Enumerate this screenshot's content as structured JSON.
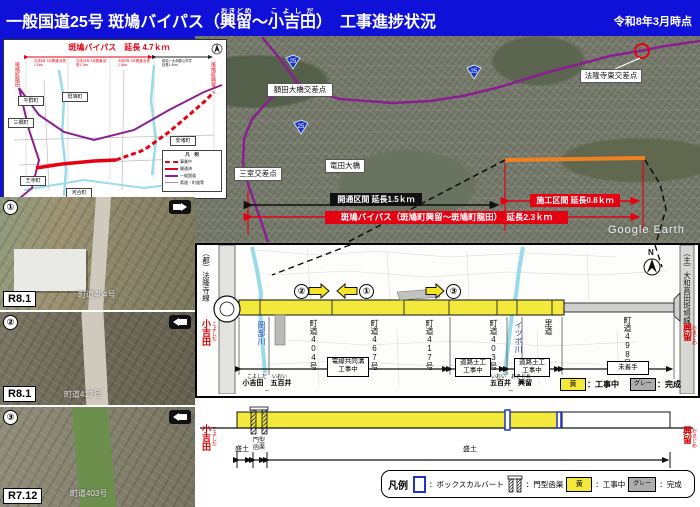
{
  "colors": {
    "header_bg": "#0f10d8",
    "red": "#e60012",
    "yellow": "#f2e93c",
    "orange": "#f08020",
    "purple": "#8a2090",
    "cyan": "#9adbe8",
    "gray_done": "#adadad"
  },
  "header": {
    "title_pre": "一般国道25号 斑鳩バイパス（",
    "r1": "興留",
    "r1_kana": "おきどめ",
    "tilde": "～",
    "r2": "小吉田",
    "r2_kana": "こよしだ",
    "title_post": "）　工事進捗状況",
    "date": "令和8年3月時点"
  },
  "inset": {
    "title": "斑鳩バイパス　延長 4.7ｋｍ",
    "left_end": "斑鳩町龍田",
    "right_end": "斑鳩町興留",
    "towns": [
      "平群町",
      "斑鳩町",
      "三郷町",
      "安堵町",
      "王寺町",
      "河合町"
    ],
    "history": [
      "平成8年 3月開通 延長1.1km",
      "平成23年 3月開通 延長1.7km",
      "令和3年 3月開通 延長1.3km",
      "斑鳩～大和郡山市境 延長1.4km"
    ],
    "legend_title": "凡　例",
    "legend": [
      "事業中",
      "開通済",
      "一般国道",
      "県道・町道等"
    ]
  },
  "aerial": {
    "int_west": "額田大橋交差点",
    "int_east": "法隆寺東交差点",
    "int_mimuro": "三室交差点",
    "bridge": "竜田大橋",
    "shield": "25",
    "opened": "開通区間 延長1.5ｋｍ",
    "constructing": "施工区間 延長0.8ｋｍ",
    "total": "斑鳩バイパス（斑鳩町興留～斑鳩町龍田）　延長2.3ｋｍ",
    "watermark": "Google Earth"
  },
  "photos": [
    {
      "no": "①",
      "date": "R8.1",
      "caption": "町道404号"
    },
    {
      "no": "②",
      "date": "R8.1",
      "caption": "町道417号"
    },
    {
      "no": "③",
      "date": "R7.12",
      "caption": "町道403号"
    }
  ],
  "plan": {
    "left_road": "（都）法隆寺線",
    "right_road": "（主）大和高田斑鳩線",
    "start": "小吉田",
    "start_kana": "こよしだ",
    "end": "興留",
    "end_kana": "おきどめ",
    "river1": "岡部川",
    "river2": "イツボ川",
    "roads": [
      "町道404号",
      "町道467号",
      "町道417号",
      "町道403号",
      "里道",
      "町道498号"
    ],
    "work1a": "電線共同溝",
    "work1b": "工事中",
    "work2a": "道路土工",
    "work2b": "工事中",
    "work3a": "道路土工",
    "work3b": "工事中",
    "work4": "未着手",
    "b1a": "小吉田",
    "b1a_kana": "こよしだ",
    "b1b": "五百井",
    "b1b_kana": "いおい",
    "b2a": "五百井",
    "b2a_kana": "いおい",
    "b2b": "興留",
    "b2b_kana": "おきどめ",
    "legend_yellow": "黄",
    "legend_yellow_desc": "：工事中",
    "legend_gray": "グレー",
    "legend_gray_desc": "：完成",
    "north": "N",
    "cam1": "①",
    "cam2": "②",
    "cam3": "③"
  },
  "profile": {
    "start": "小吉田",
    "start_kana": "こよしだ",
    "end": "興留",
    "end_kana": "おきどめ",
    "seg1": "盛土",
    "seg2a": "門型",
    "seg2b": "函渠",
    "seg3": "盛土"
  },
  "legend": {
    "title": "凡例",
    "box_desc": "：ボックスカルバート",
    "portal_desc": "：門型函渠",
    "yellow": "黄",
    "yellow_desc": "：工事中",
    "gray": "グレー",
    "gray_desc": "：完成"
  }
}
